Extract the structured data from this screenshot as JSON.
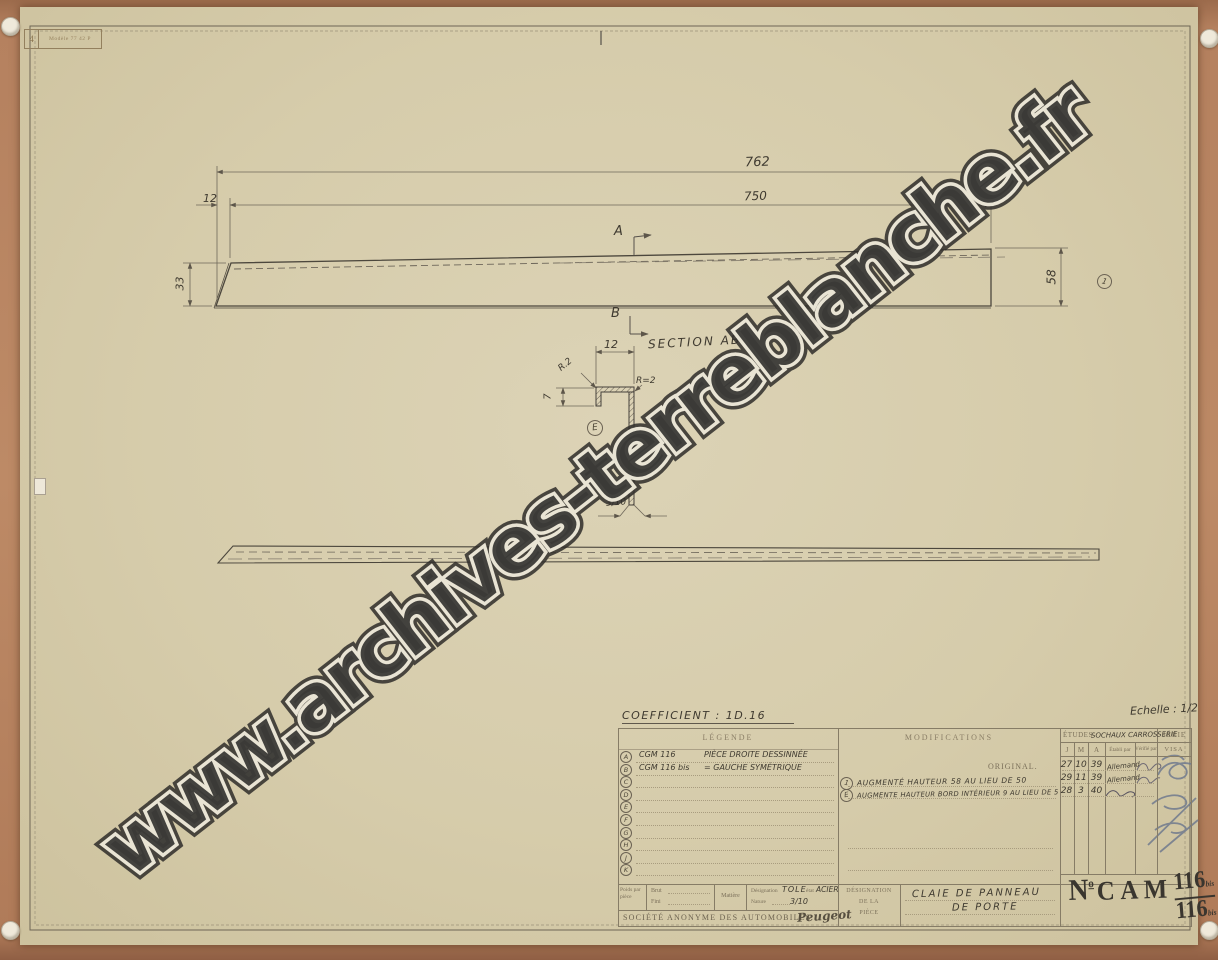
{
  "watermark": {
    "text": "www.archives-terreblanche.fr"
  },
  "corner_stamp": {
    "number": "4",
    "text": "Modèle 77 42 P"
  },
  "drawing": {
    "dim_762": "762",
    "dim_750": "750",
    "dim_12_top": "12",
    "dim_33": "33",
    "dim_58": "58",
    "marker_a": "A",
    "marker_b": "B",
    "balloon_1": "1",
    "balloon_e": "E",
    "section_title": "SECTION AB",
    "dim_12_section": "12",
    "dim_7": "7",
    "dim_3_10": "3/10",
    "radius_leader": "R.2",
    "radius_label": "R=2"
  },
  "table": {
    "coefficient": "COEFFICIENT : 1D.16",
    "echelle": "Echelle : 1/2",
    "legend": {
      "header": "LÉGENDE",
      "rows": [
        {
          "letter": "A",
          "ref": "CGM 116",
          "text": "PIÈCE DROITE DESSINNÉE"
        },
        {
          "letter": "B",
          "ref": "CGM 116 bis",
          "text": "=   GAUCHE SYMÉTRIQUE"
        },
        {
          "letter": "C",
          "ref": "",
          "text": ""
        },
        {
          "letter": "D",
          "ref": "",
          "text": ""
        },
        {
          "letter": "E",
          "ref": "",
          "text": ""
        },
        {
          "letter": "F",
          "ref": "",
          "text": ""
        },
        {
          "letter": "G",
          "ref": "",
          "text": ""
        },
        {
          "letter": "H",
          "ref": "",
          "text": ""
        },
        {
          "letter": "J",
          "ref": "",
          "text": ""
        },
        {
          "letter": "K",
          "ref": "",
          "text": ""
        }
      ]
    },
    "modifications": {
      "header": "MODIFICATIONS",
      "original_label": "ORIGINAL.",
      "rows": [
        {
          "marker": "1",
          "text": "AUGMENTÉ HAUTEUR 58 AU LIEU DE 50"
        },
        {
          "marker": "E",
          "text": "AUGMENTE HAUTEUR BORD INTÉRIEUR 9 AU LIEU DE 5"
        }
      ]
    },
    "etudes": {
      "label": "ÉTUDES",
      "dept_handwritten": "SOCHAUX  CARROSSERIE",
      "serie": "SÉRIE",
      "col_j": "J",
      "col_m": "M",
      "col_a": "A",
      "col_etabli": "Établi par",
      "col_verifie": "Vérifié par",
      "col_visa": "VISA",
      "rows": [
        {
          "j": "27",
          "m": "10",
          "a": "39",
          "etabli": "Allemand"
        },
        {
          "j": "29",
          "m": "11",
          "a": "39",
          "etabli": "Allemand"
        },
        {
          "j": "28",
          "m": "3",
          "a": "40",
          "etabli": ""
        }
      ]
    },
    "material": {
      "poids": "Poids par pièce",
      "brut": "Brut",
      "fini": "Fini",
      "matiere": "Matière",
      "designation_label": "Désignation",
      "designation_value": "TOLE",
      "etat_label": "état",
      "etat_value": "ACIER",
      "nature_label": "Nature",
      "nature_value": "3/10"
    },
    "piece": {
      "label_line1": "DÉSIGNATION",
      "label_line2": "DE LA",
      "label_line3": "PIÈCE",
      "name_line1": "CLAIE DE PANNEAU",
      "name_line2": "DE PORTE"
    },
    "number": {
      "n": "N",
      "deg": "o",
      "cam": "CAM",
      "top": "116",
      "top_suffix": "bis",
      "bottom": "116",
      "bottom_suffix": "bis"
    },
    "societe": {
      "name": "SOCIÉTÉ ANONYME DES AUTOMOBILES",
      "logo": "Peugeot"
    }
  }
}
